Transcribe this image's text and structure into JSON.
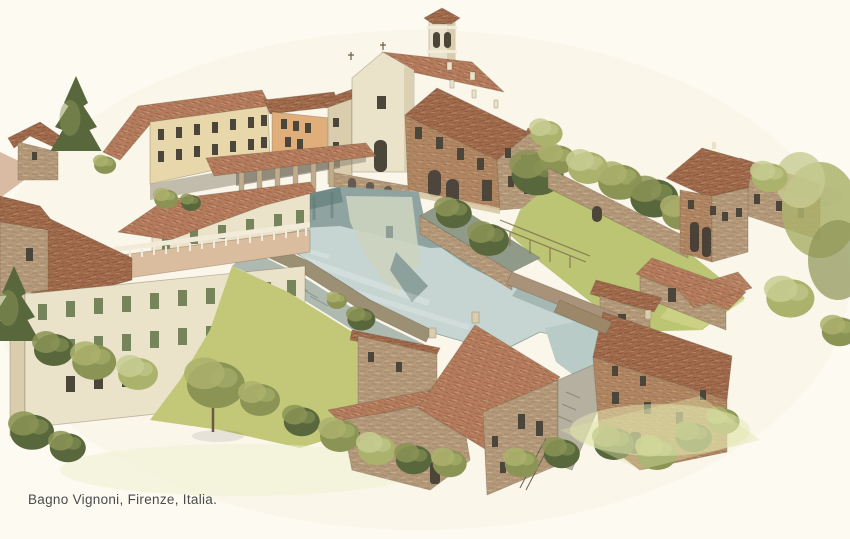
{
  "caption": {
    "text": "Bagno Vignoni, Firenze, Italia."
  },
  "scene": {
    "description": "Aerial watercolor illustration of the village of Bagno Vignoni with its central thermal water pool surrounded by stone houses with terracotta roofs, a church with bell tower, gardens, walls and trees.",
    "landmarks": [
      "church-and-bell-tower",
      "loggia-palazzo",
      "arcade-portico",
      "thermal-pool",
      "pool-walkway",
      "garden-terrace",
      "left-palazzo-with-terrace",
      "long-building",
      "orange-house",
      "garden-wall",
      "right-lawn",
      "mill-tower",
      "mill-wing",
      "stone-houses-cluster",
      "cypress-and-olive-trees"
    ]
  },
  "palette": {
    "paper": "#fdfaf2",
    "wash": "#f7f1e0",
    "roof": "#b47c5c",
    "roof-line": "#7d4e36",
    "roof-dark": "#a06a4c",
    "roof-dark-line": "#6f4129",
    "roof-hi": "#d8ac88",
    "stone": "#b49a7a",
    "stone-dark": "#85684c",
    "stone-hi": "#d8c6a4",
    "brick": "#b08662",
    "brick-dark": "#7e5a3c",
    "cream": "#ebe2ca",
    "cream-shade": "#d9cdae",
    "yellow-wall": "#e7d7aa",
    "orange-wall": "#e0ae7a",
    "water": "#c6d5d1",
    "water-deep": "#6f8a86",
    "reflect-dark": "#8ca19d",
    "reflect-cream": "#ccd3bf",
    "reflect-green": "#7f968c",
    "channel": "#b9cbc7",
    "walkway": "#aeb9b0",
    "parapet": "#9b8f74",
    "grass": "#c2c878",
    "lawn": "#bcc573",
    "grass-wash": "#e6e9b4",
    "tree-dark": "#59683c",
    "tree-olive": "#8b9455",
    "tree-light": "#abb26c",
    "tree-pale": "#c7cc92",
    "shutter": "#76845c",
    "win": "#4b453a",
    "terrace-floor": "#dabc9e",
    "balustrade": "#f2ebd9",
    "ink": "#6b5d48",
    "caption": "#4a4a4b"
  }
}
